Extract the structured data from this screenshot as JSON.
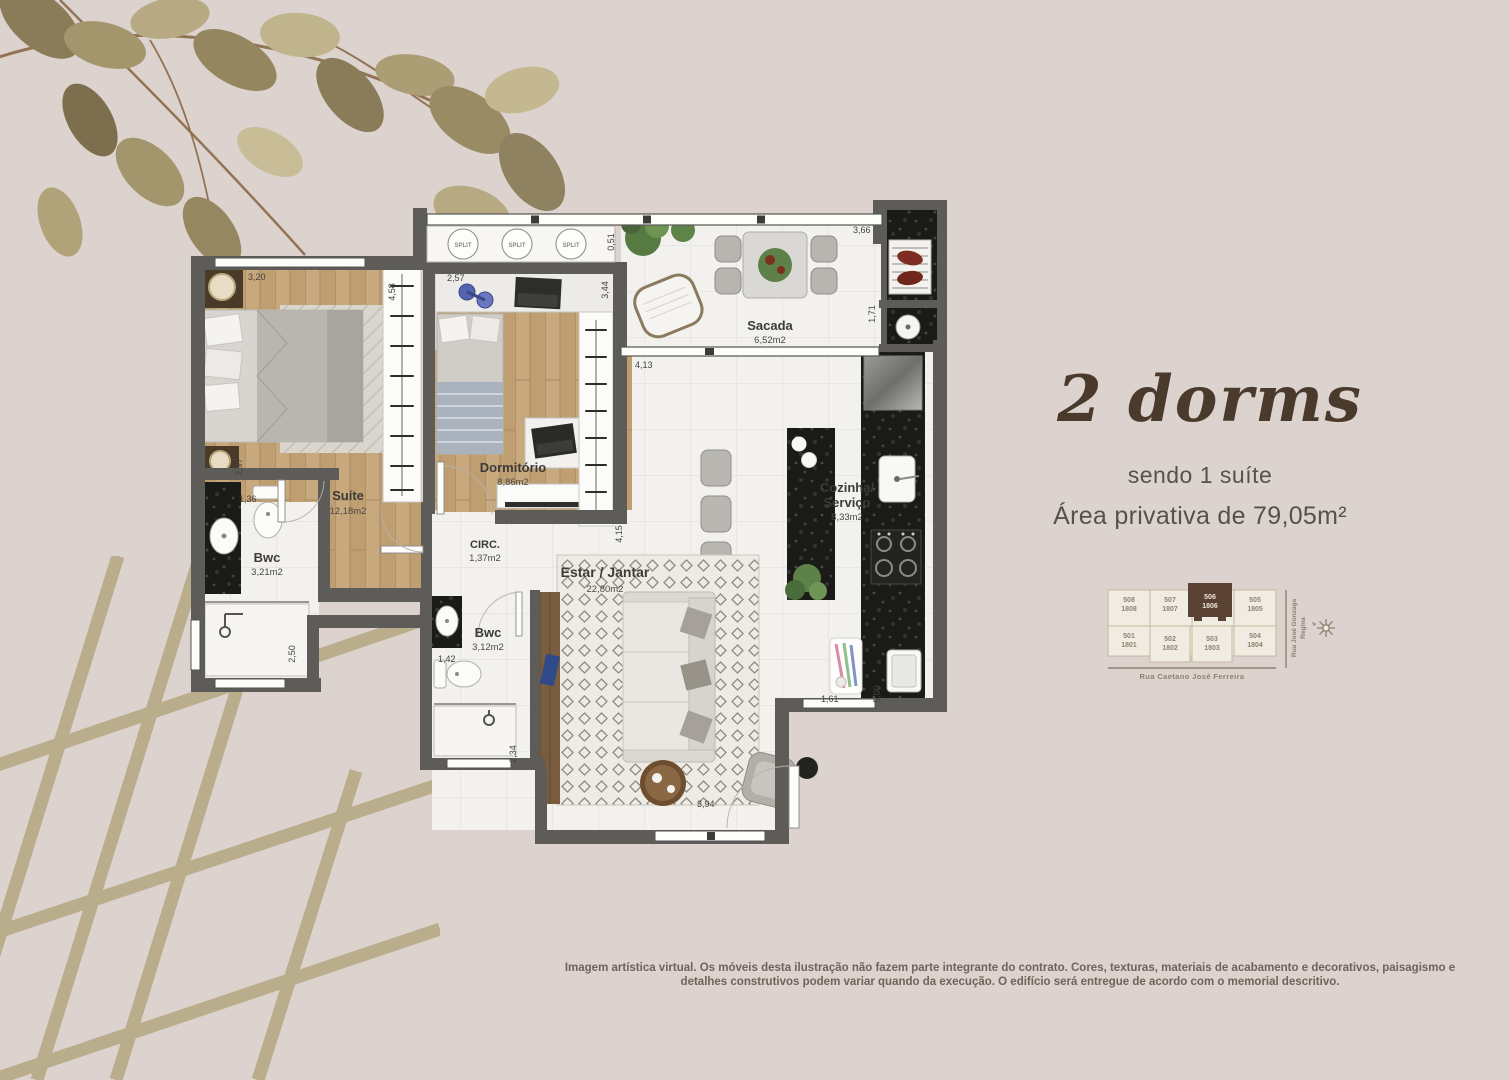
{
  "title": {
    "headline": "2 dorms",
    "subtitle": "sendo 1 suíte",
    "area_line": "Área privativa de 79,05m²"
  },
  "plan": {
    "split_label": "SPLIT",
    "rooms": {
      "suite": {
        "name": "Suíte",
        "area": "12,18m2"
      },
      "dormitorio": {
        "name": "Dormitório",
        "area": "8,86m2"
      },
      "bwc_suite": {
        "name": "Bwc",
        "area": "3,21m2"
      },
      "bwc_social": {
        "name": "Bwc",
        "area": "3,12m2"
      },
      "circ": {
        "name": "CIRC.",
        "area": "1,37m2"
      },
      "estar": {
        "name": "Estar / Jantar",
        "area": "22,80m2"
      },
      "cozinha": {
        "name_line1": "Cozinha/",
        "name_line2": "Serviço",
        "area": "8,33m2"
      },
      "sacada": {
        "name": "Sacada",
        "area": "6,52m2"
      }
    },
    "dims": {
      "d320": "3,20",
      "d458": "4,58",
      "d257": "2,57",
      "d344": "3,44",
      "d051": "0,51",
      "d366": "3,66",
      "d171": "1,71",
      "d413": "4,13",
      "d297": "2,97",
      "d136": "1,36",
      "d415": "4,15",
      "d250": "2,50",
      "d142": "1,42",
      "d234": "2,34",
      "d394": "3,94",
      "d161": "1,61",
      "d500": "5,00"
    }
  },
  "minimap": {
    "top_units": [
      [
        "508",
        "1808"
      ],
      [
        "507",
        "1807"
      ],
      [
        "506",
        "1806"
      ],
      [
        "505",
        "1805"
      ]
    ],
    "bottom_units": [
      [
        "501",
        "1801"
      ],
      [
        "502",
        "1802"
      ],
      [
        "503",
        "1803"
      ],
      [
        "504",
        "1804"
      ]
    ],
    "highlighted_unit": "506",
    "highlight_color": "#5a4334",
    "street_bottom": "Rua Caetano José Ferreira",
    "street_right_line1": "Rua José Gonzaga",
    "street_right_line2": "Regina"
  },
  "footer": {
    "disclaimer_line1": "Imagem artística virtual. Os móveis desta ilustração não fazem parte integrante do contrato. Cores, texturas, materiais de acabamento e decorativos, paisagismo e",
    "disclaimer_line2": "detalhes construtivos podem variar quando da execução. O edifício será entregue de acordo com o memorial descritivo."
  }
}
